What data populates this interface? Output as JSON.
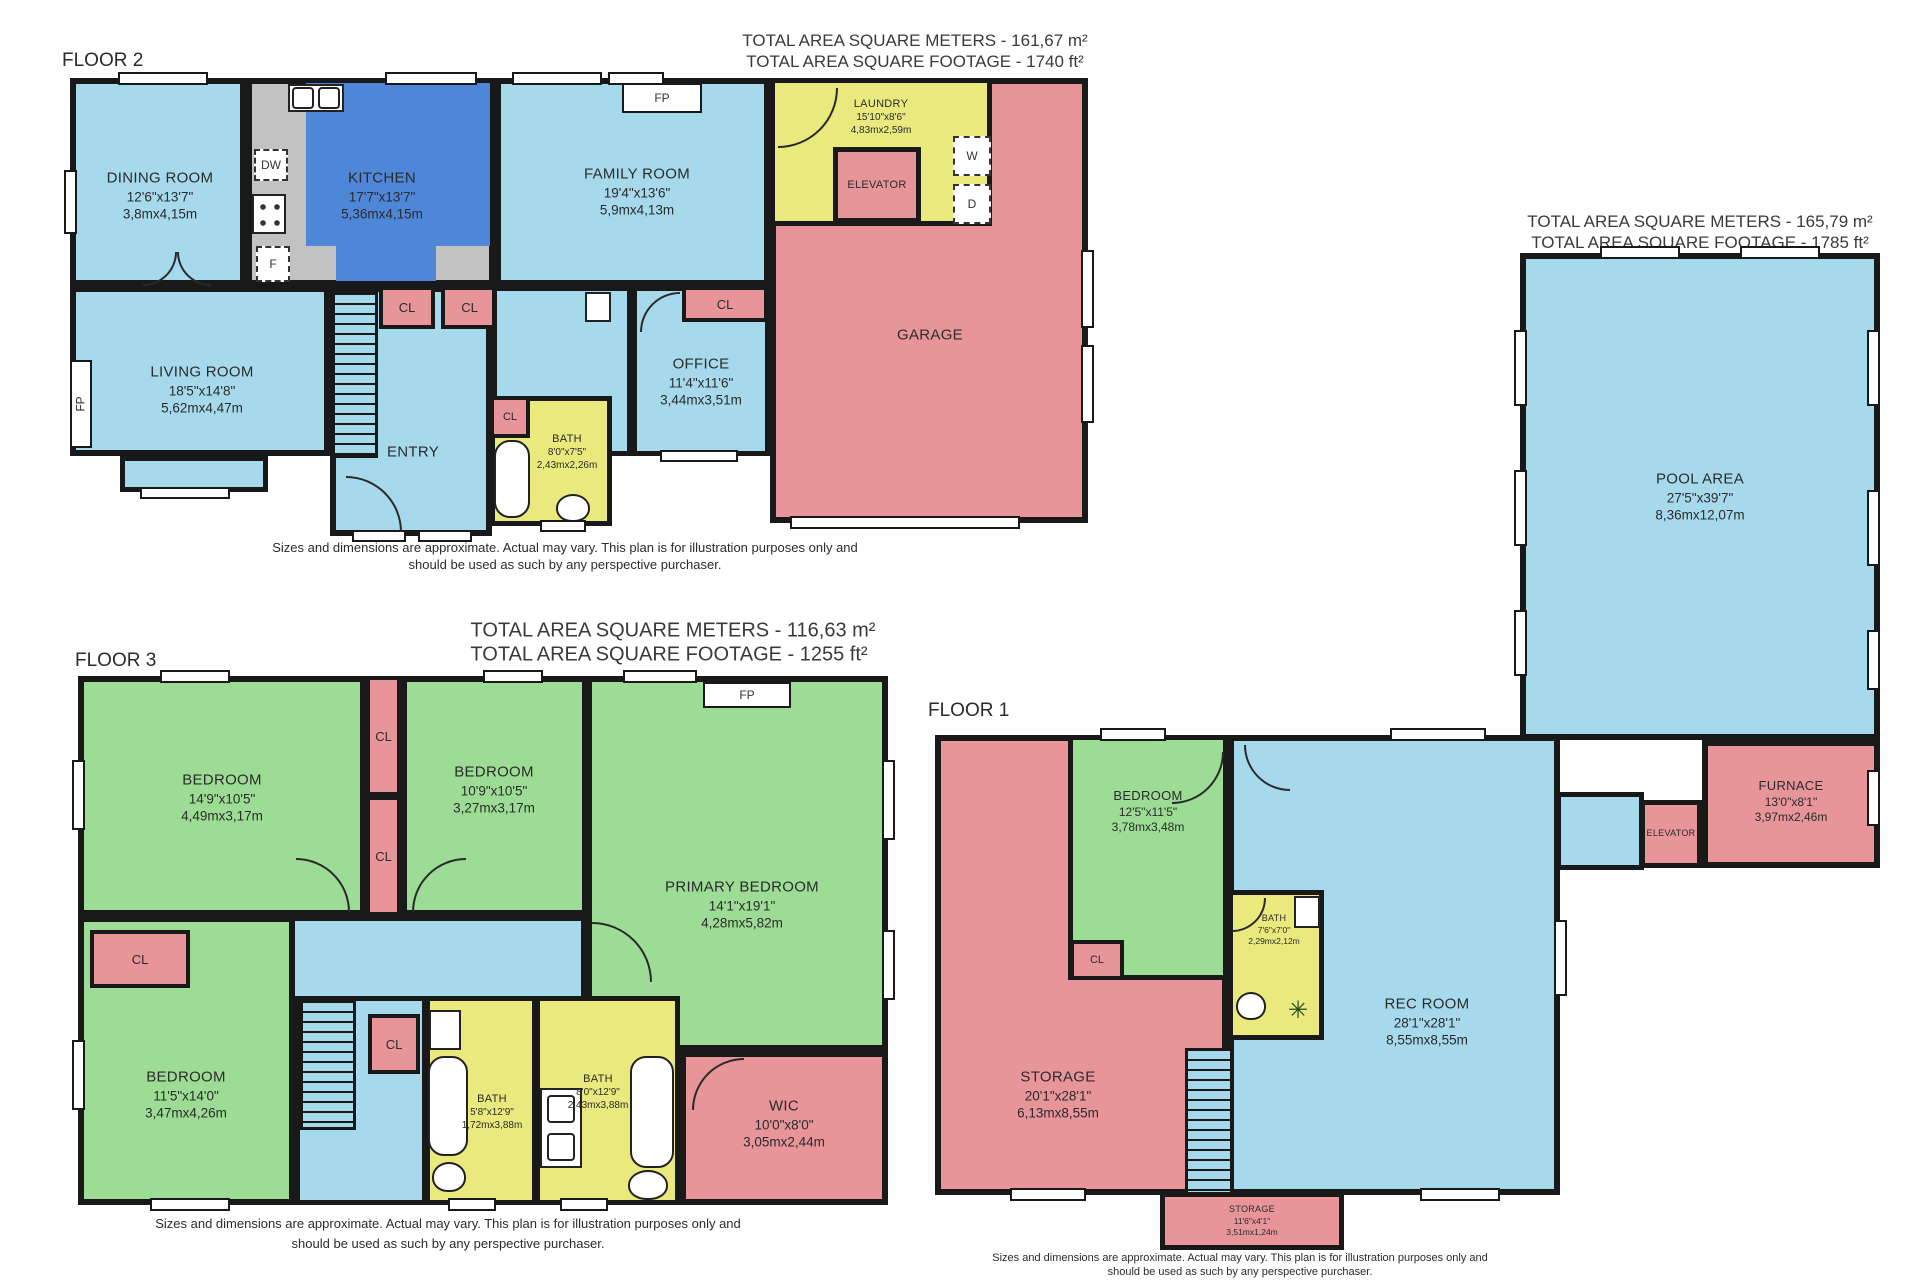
{
  "common": {
    "cl": "CL",
    "fp": "FP",
    "dw": "DW",
    "f": "F",
    "w": "W",
    "d": "D",
    "disclaimer_line1": "Sizes and dimensions are approximate. Actual may vary. This plan is for illustration purposes only and",
    "disclaimer_line2": "should be used as such by any perspective purchaser."
  },
  "colors": {
    "room_blue": "#a7d9ec",
    "kitchen_blue": "#4e86d8",
    "room_green": "#9cdc95",
    "room_pink": "#e8959a",
    "room_yellow": "#eae97e",
    "counter_gray": "#c2c2c2",
    "wall": "#191919"
  },
  "floor2": {
    "label": "FLOOR 2",
    "total_meters": "TOTAL AREA SQUARE METERS - 161,67 m²",
    "total_footage": "TOTAL AREA SQUARE FOOTAGE  - 1740 ft²",
    "rooms": {
      "dining": {
        "name": "DINING ROOM",
        "imperial": "12'6\"x13'7\"",
        "metric": "3,8mx4,15m"
      },
      "kitchen": {
        "name": "KITCHEN",
        "imperial": "17'7\"x13'7\"",
        "metric": "5,36mx4,15m"
      },
      "family": {
        "name": "FAMILY ROOM",
        "imperial": "19'4\"x13'6\"",
        "metric": "5,9mx4,13m"
      },
      "laundry": {
        "name": "LAUNDRY",
        "imperial": "15'10\"x8'6\"",
        "metric": "4,83mx2,59m"
      },
      "elevator": {
        "name": "ELEVATOR"
      },
      "garage": {
        "name": "GARAGE"
      },
      "living": {
        "name": "LIVING ROOM",
        "imperial": "18'5\"x14'8\"",
        "metric": "5,62mx4,47m"
      },
      "entry": {
        "name": "ENTRY"
      },
      "bath": {
        "name": "BATH",
        "imperial": "8'0\"x7'5\"",
        "metric": "2,43mx2,26m"
      },
      "office": {
        "name": "OFFICE",
        "imperial": "11'4\"x11'6\"",
        "metric": "3,44mx3,51m"
      }
    }
  },
  "floor3": {
    "label": "FLOOR 3",
    "total_meters": "TOTAL AREA SQUARE METERS - 116,63 m²",
    "total_footage": "TOTAL AREA SQUARE FOOTAGE  - 1255 ft²",
    "rooms": {
      "bedroom_a": {
        "name": "BEDROOM",
        "imperial": "14'9\"x10'5\"",
        "metric": "4,49mx3,17m"
      },
      "bedroom_b": {
        "name": "BEDROOM",
        "imperial": "10'9\"x10'5\"",
        "metric": "3,27mx3,17m"
      },
      "primary": {
        "name": "PRIMARY BEDROOM",
        "imperial": "14'1\"x19'1\"",
        "metric": "4,28mx5,82m"
      },
      "bedroom_c": {
        "name": "BEDROOM",
        "imperial": "11'5\"x14'0\"",
        "metric": "3,47mx4,26m"
      },
      "bath_a": {
        "name": "BATH",
        "imperial": "5'8\"x12'9\"",
        "metric": "1,72mx3,88m"
      },
      "bath_b": {
        "name": "BATH",
        "imperial": "8'0\"x12'9\"",
        "metric": "2,43mx3,88m"
      },
      "wic": {
        "name": "WIC",
        "imperial": "10'0\"x8'0\"",
        "metric": "3,05mx2,44m"
      }
    }
  },
  "floor1": {
    "label": "FLOOR 1",
    "total_meters": "TOTAL AREA SQUARE METERS - 165,79 m²",
    "total_footage": "TOTAL AREA SQUARE FOOTAGE  - 1785 ft²",
    "rooms": {
      "storage": {
        "name": "STORAGE",
        "imperial": "20'1\"x28'1\"",
        "metric": "6,13mx8,55m"
      },
      "bedroom": {
        "name": "BEDROOM",
        "imperial": "12'5\"x11'5\"",
        "metric": "3,78mx3,48m"
      },
      "bath": {
        "name": "BATH",
        "imperial": "7'6\"x7'0\"",
        "metric": "2,29mx2,12m"
      },
      "rec": {
        "name": "REC ROOM",
        "imperial": "28'1\"x28'1\"",
        "metric": "8,55mx8,55m"
      },
      "storage_bottom": {
        "name": "STORAGE",
        "imperial": "11'6\"x4'1\"",
        "metric": "3,51mx1,24m"
      },
      "furnace": {
        "name": "FURNACE",
        "imperial": "13'0\"x8'1\"",
        "metric": "3,97mx2,46m"
      },
      "elevator": {
        "name": "ELEVATOR"
      },
      "pool": {
        "name": "POOL AREA",
        "imperial": "27'5\"x39'7\"",
        "metric": "8,36mx12,07m"
      }
    }
  }
}
